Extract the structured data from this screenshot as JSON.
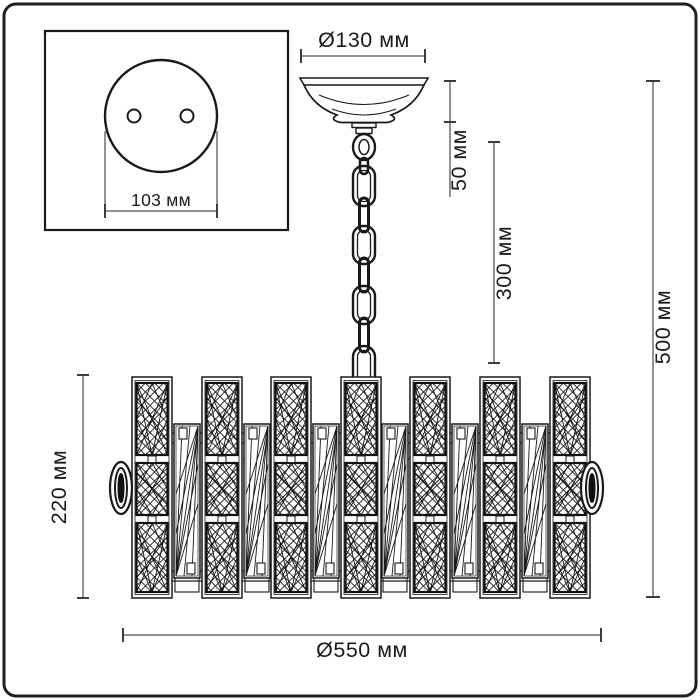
{
  "diagram": {
    "type": "chandelier-dimension-drawing",
    "unit": "мм",
    "labels": {
      "canopy_diameter": "Ø130 мм",
      "canopy_height": "50 мм",
      "chain_length": "300 мм",
      "total_height": "500 мм",
      "body_height": "220 мм",
      "body_diameter": "Ø550 мм",
      "mount_plate_width": "103 мм"
    },
    "colors": {
      "outline": "#1a1a1a",
      "dimension_line": "#6e6e6e",
      "tick": "#3c3c3c",
      "text": "#1a1a1a",
      "background": "#ffffff"
    }
  }
}
